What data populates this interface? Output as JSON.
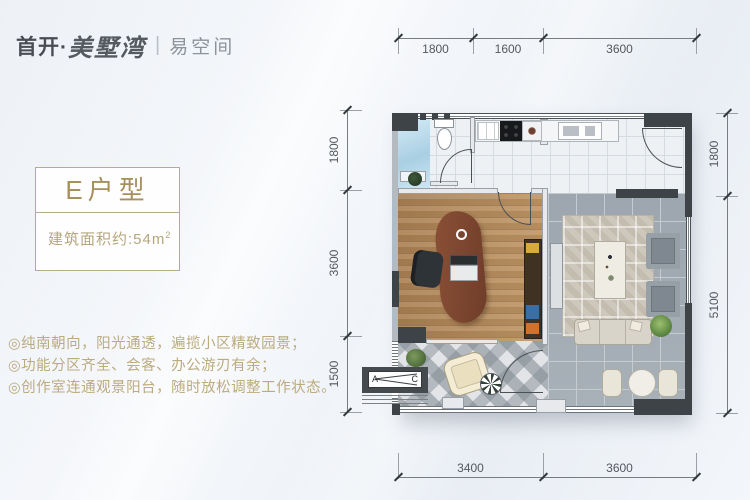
{
  "logo": {
    "prefix": "首开·",
    "script": "美墅湾",
    "divider": "|",
    "sub": "易空间"
  },
  "unit_panel": {
    "title": "E户型",
    "area_label": "建筑面积约:54m",
    "area_sup": "2"
  },
  "features": [
    "◎纯南朝向，阳光通透，遍揽小区精致园景；",
    "◎功能分区齐全、会客、办公游刃有余；",
    "◎创作室连通观景阳台，随时放松调整工作状态。"
  ],
  "floorplan": {
    "dimensions": {
      "top": [
        "1800",
        "1600",
        "3600"
      ],
      "left": [
        "1800",
        "3600",
        "1500"
      ],
      "right": [
        "1800",
        "5100"
      ],
      "bottom": [
        "3400",
        "3600"
      ]
    },
    "ac_unit": {
      "left_label": "A",
      "right_label": "C"
    }
  },
  "colors": {
    "accent_gold": "#a6905c",
    "wall_dark": "#3e4347",
    "logo_dark": "#4a4e54",
    "background": "#eef2f7"
  }
}
